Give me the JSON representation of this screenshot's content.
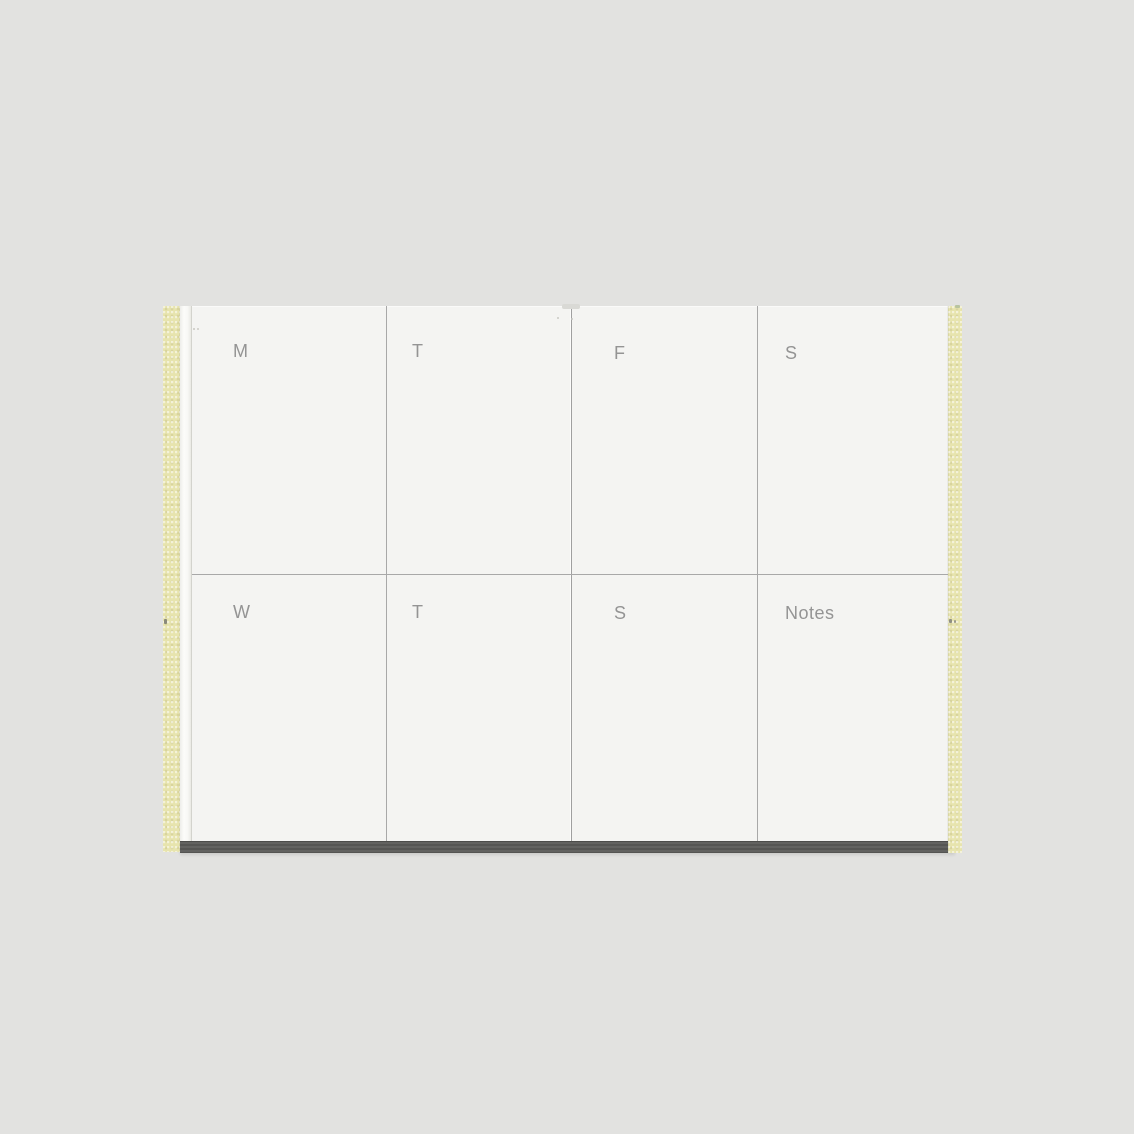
{
  "planner": {
    "rows": [
      {
        "cells": [
          {
            "label": "M"
          },
          {
            "label": "T"
          },
          {
            "label": "F"
          },
          {
            "label": "S"
          }
        ]
      },
      {
        "cells": [
          {
            "label": "W"
          },
          {
            "label": "T"
          },
          {
            "label": "S"
          },
          {
            "label": "Notes"
          }
        ]
      }
    ]
  },
  "colors": {
    "background": "#e2e2e0",
    "page": "#f4f4f2",
    "sheet_edge": "#fafaf8",
    "binding_strip": "#e7e4ae",
    "grid_line": "#a8a8a8",
    "label_text": "#949494",
    "base_bar": "#5b5b59"
  }
}
